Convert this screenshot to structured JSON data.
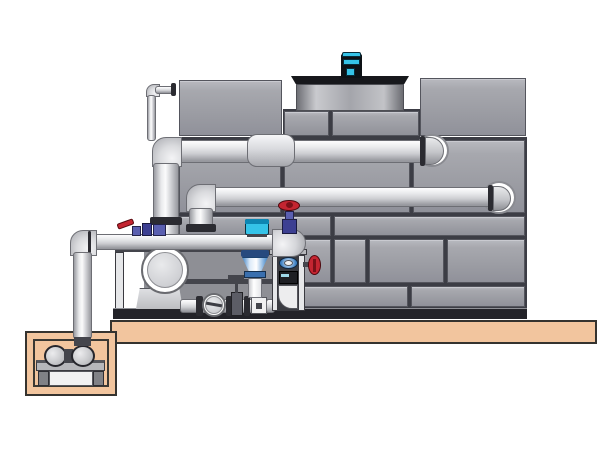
{
  "meta": {
    "description": "Technical illustration of a closed-circuit cooling tower with external piping, pump skid, suction sump pit, fan motor and valves",
    "visible_text": []
  },
  "colors": {
    "background": "#ffffff",
    "panel_gray": "#a3a4ab",
    "pipe_gray": "#dcdde0",
    "tan": "#f2c59e",
    "red": "#c42531",
    "teal": "#35c3e8",
    "blue": "#3d7fc1",
    "purple": "#5a5fb0",
    "dark": "#232329"
  },
  "components": [
    {
      "n": "platform-slab",
      "cls": "tan",
      "x": 110,
      "y": 320,
      "w": 487,
      "h": 24
    },
    {
      "n": "sump-pit-outer",
      "cls": "tan",
      "x": 25,
      "y": 331,
      "w": 92,
      "h": 65
    },
    {
      "n": "sump-pit-cavity",
      "cls": "tan-inner",
      "x": 33,
      "y": 339,
      "w": 76,
      "h": 48
    },
    {
      "n": "sump-pump-plate",
      "cls": "plate",
      "x": 36,
      "y": 360,
      "w": 69,
      "h": 11
    },
    {
      "n": "sump-pump-leg-left",
      "cls": "leg",
      "x": 38,
      "y": 371,
      "w": 11,
      "h": 15
    },
    {
      "n": "sump-pump-leg-right",
      "cls": "leg",
      "x": 93,
      "y": 371,
      "w": 11,
      "h": 15
    },
    {
      "n": "sump-pump-box",
      "cls": "whitebox",
      "x": 49,
      "y": 371,
      "w": 44,
      "h": 15
    },
    {
      "n": "sump-pump-bell-left",
      "cls": "pumpcirc ell",
      "x": 44,
      "y": 345,
      "w": 23,
      "h": 22
    },
    {
      "n": "sump-pump-coupling",
      "cls": "dark2",
      "x": 64,
      "y": 349,
      "w": 9,
      "h": 14
    },
    {
      "n": "sump-pump-bell-right",
      "cls": "pumpcirc ell",
      "x": 71,
      "y": 345,
      "w": 24,
      "h": 22
    },
    {
      "n": "tower-frame-underlay",
      "cls": "underlay",
      "x": 178,
      "y": 137,
      "w": 349,
      "h": 172
    },
    {
      "n": "tower-band-underlay",
      "cls": "underlay",
      "x": 283,
      "y": 109,
      "w": 137,
      "h": 30
    },
    {
      "n": "tower-panel-top-left",
      "cls": "panel",
      "x": 179,
      "y": 80,
      "w": 103,
      "h": 56
    },
    {
      "n": "tower-panel-top-right",
      "cls": "panel",
      "x": 420,
      "y": 78,
      "w": 106,
      "h": 58
    },
    {
      "n": "tower-panel-band-left",
      "cls": "panel",
      "x": 284,
      "y": 111,
      "w": 45,
      "h": 25
    },
    {
      "n": "tower-panel-band-right",
      "cls": "panel",
      "x": 332,
      "y": 111,
      "w": 87,
      "h": 25
    },
    {
      "n": "tower-panel",
      "cls": "panel",
      "x": 179,
      "y": 140,
      "w": 102,
      "h": 73
    },
    {
      "n": "tower-panel",
      "cls": "panel",
      "x": 284,
      "y": 140,
      "w": 126,
      "h": 73
    },
    {
      "n": "tower-panel",
      "cls": "panel",
      "x": 413,
      "y": 140,
      "w": 112,
      "h": 73
    },
    {
      "n": "tower-panel",
      "cls": "panel",
      "x": 179,
      "y": 216,
      "w": 152,
      "h": 20
    },
    {
      "n": "tower-panel",
      "cls": "panel",
      "x": 334,
      "y": 216,
      "w": 191,
      "h": 20
    },
    {
      "n": "tower-panel",
      "cls": "panel",
      "x": 179,
      "y": 239,
      "w": 152,
      "h": 44
    },
    {
      "n": "tower-panel",
      "cls": "panel",
      "x": 334,
      "y": 239,
      "w": 32,
      "h": 44
    },
    {
      "n": "tower-panel",
      "cls": "panel",
      "x": 369,
      "y": 239,
      "w": 75,
      "h": 44
    },
    {
      "n": "tower-panel",
      "cls": "panel",
      "x": 447,
      "y": 239,
      "w": 78,
      "h": 44
    },
    {
      "n": "tower-panel",
      "cls": "panel",
      "x": 179,
      "y": 286,
      "w": 229,
      "h": 21
    },
    {
      "n": "tower-panel",
      "cls": "panel",
      "x": 411,
      "y": 286,
      "w": 114,
      "h": 21
    },
    {
      "n": "tower-base-band",
      "cls": "darkband",
      "x": 178,
      "y": 308,
      "w": 349,
      "h": 11
    },
    {
      "n": "fan-deck-rim",
      "cls": "rim",
      "x": 291,
      "y": 76,
      "w": 118,
      "h": 8,
      "clip": "polygon(0 0,100% 0,96% 100%,4% 100%)"
    },
    {
      "n": "fan-cowl-drum",
      "cls": "drum",
      "x": 296,
      "y": 84,
      "w": 108,
      "h": 27
    },
    {
      "n": "fan-motor-base",
      "cls": "dark",
      "x": 339,
      "y": 76,
      "w": 25,
      "h": 4
    },
    {
      "n": "fan-motor-body",
      "cls": "motordark",
      "x": 341,
      "y": 54,
      "w": 21,
      "h": 24
    },
    {
      "n": "fan-motor-cap",
      "cls": "cyan",
      "x": 342,
      "y": 52,
      "w": 19,
      "h": 5,
      "r": "2px 2px 0 0"
    },
    {
      "n": "fan-motor-band",
      "cls": "cyan",
      "x": 343,
      "y": 59,
      "w": 17,
      "h": 6
    },
    {
      "n": "fan-motor-window",
      "cls": "cyan",
      "x": 346,
      "y": 68,
      "w": 9,
      "h": 8
    },
    {
      "n": "makeup-pipe-elbow",
      "cls": "elbow",
      "x": 146,
      "y": 84,
      "w": 14,
      "h": 13,
      "r": "8px 0 0 0"
    },
    {
      "n": "makeup-pipe-horizontal",
      "cls": "pipe-h",
      "x": 155,
      "y": 86,
      "w": 19,
      "h": 8
    },
    {
      "n": "makeup-pipe-wall-flange",
      "cls": "flange",
      "x": 171,
      "y": 83,
      "w": 5,
      "h": 13
    },
    {
      "n": "makeup-pipe-vertical",
      "cls": "pipe-v",
      "x": 147,
      "y": 95,
      "w": 9,
      "h": 46
    },
    {
      "n": "upper-header-wall-ring",
      "cls": "ring ell",
      "x": 415,
      "y": 134,
      "w": 34,
      "h": 33
    },
    {
      "n": "upper-header-pipe",
      "cls": "pipe-h",
      "x": 172,
      "y": 140,
      "w": 258,
      "h": 23
    },
    {
      "n": "upper-header-end-flange",
      "cls": "flange",
      "x": 420,
      "y": 136,
      "w": 5,
      "h": 30
    },
    {
      "n": "upper-header-dome",
      "cls": "dome",
      "x": 425,
      "y": 137,
      "w": 19,
      "h": 28,
      "r": "0 14px 14px 0"
    },
    {
      "n": "upper-header-elbow",
      "cls": "elbow",
      "x": 152,
      "y": 137,
      "w": 30,
      "h": 30,
      "r": "14px 0 0 0"
    },
    {
      "n": "upper-riser-pipe",
      "cls": "pipe-v",
      "x": 153,
      "y": 163,
      "w": 26,
      "h": 73
    },
    {
      "n": "upper-riser-flange",
      "cls": "flange",
      "x": 150,
      "y": 217,
      "w": 32,
      "h": 8
    },
    {
      "n": "upper-header-coupling",
      "cls": "coupling",
      "x": 247,
      "y": 134,
      "w": 48,
      "h": 33,
      "r": "10px"
    },
    {
      "n": "middle-header-wall-ring",
      "cls": "ring ell",
      "x": 482,
      "y": 181,
      "w": 34,
      "h": 33
    },
    {
      "n": "middle-header-pipe",
      "cls": "pipe-h",
      "x": 206,
      "y": 187,
      "w": 286,
      "h": 20
    },
    {
      "n": "middle-header-end-flange",
      "cls": "flange",
      "x": 488,
      "y": 185,
      "w": 5,
      "h": 26
    },
    {
      "n": "middle-header-dome",
      "cls": "dome",
      "x": 493,
      "y": 186,
      "w": 18,
      "h": 25,
      "r": "0 13px 13px 0"
    },
    {
      "n": "middle-header-elbow",
      "cls": "elbow",
      "x": 186,
      "y": 184,
      "w": 30,
      "h": 28,
      "r": "14px 0 0 0"
    },
    {
      "n": "middle-riser-pipe",
      "cls": "pipe-v",
      "x": 189,
      "y": 208,
      "w": 24,
      "h": 20
    },
    {
      "n": "middle-riser-flange",
      "cls": "flange",
      "x": 186,
      "y": 224,
      "w": 30,
      "h": 8
    },
    {
      "n": "pump-skid-backdrop",
      "cls": "skidback",
      "x": 144,
      "y": 250,
      "w": 158,
      "h": 60
    },
    {
      "n": "pump-skid-top-rail",
      "cls": "dark2",
      "x": 115,
      "y": 248,
      "w": 188,
      "h": 4
    },
    {
      "n": "pump-skid-mid-rail",
      "cls": "dark2",
      "x": 183,
      "y": 279,
      "w": 119,
      "h": 5
    },
    {
      "n": "pump-skid-left-column",
      "cls": "lightcol",
      "x": 115,
      "y": 252,
      "w": 9,
      "h": 58
    },
    {
      "n": "pump-skid-base",
      "cls": "darkband",
      "x": 113,
      "y": 308,
      "w": 191,
      "h": 11
    },
    {
      "n": "main-pump-pedestal",
      "cls": "pedestal",
      "x": 136,
      "y": 288,
      "w": 47,
      "h": 21,
      "clip": "polygon(8% 0,92% 0,100% 100%,0 100%)"
    },
    {
      "n": "main-pump-flange-ring",
      "cls": "ring2 ell",
      "x": 141,
      "y": 246,
      "w": 48,
      "h": 48
    },
    {
      "n": "main-pump-face",
      "cls": "pumpface ell",
      "x": 147,
      "y": 252,
      "w": 36,
      "h": 36
    },
    {
      "n": "suction-manifold-pipe",
      "cls": "pipe-h",
      "x": 180,
      "y": 299,
      "w": 94,
      "h": 14
    },
    {
      "n": "manifold-flange-1",
      "cls": "flange",
      "x": 196,
      "y": 296,
      "w": 7,
      "h": 20
    },
    {
      "n": "check-valve-ring",
      "cls": "ring2 ell",
      "x": 202,
      "y": 293,
      "w": 24,
      "h": 24
    },
    {
      "n": "check-valve-disc",
      "cls": "pumpface ell",
      "x": 205,
      "y": 296,
      "w": 18,
      "h": 18
    },
    {
      "n": "check-valve-slash",
      "cls": "slash",
      "x": 206,
      "y": 303,
      "w": 16,
      "h": 3,
      "rot": 10
    },
    {
      "n": "manifold-flange-2",
      "cls": "flange",
      "x": 226,
      "y": 296,
      "w": 6,
      "h": 20
    },
    {
      "n": "manifold-gate-valve-body",
      "cls": "gatebody",
      "x": 231,
      "y": 292,
      "w": 12,
      "h": 24
    },
    {
      "n": "manifold-gate-valve-stem",
      "cls": "dark2",
      "x": 235,
      "y": 279,
      "w": 3,
      "h": 14
    },
    {
      "n": "manifold-gate-valve-handle",
      "cls": "dark2",
      "x": 228,
      "y": 275,
      "w": 16,
      "h": 4
    },
    {
      "n": "manifold-flange-3",
      "cls": "flange",
      "x": 244,
      "y": 296,
      "w": 6,
      "h": 20
    },
    {
      "n": "manifold-union-block",
      "cls": "whitebox",
      "x": 251,
      "y": 297,
      "w": 16,
      "h": 17
    },
    {
      "n": "manifold-union-bolt",
      "cls": "dark2",
      "x": 256,
      "y": 303,
      "w": 6,
      "h": 6
    },
    {
      "n": "manifold-pipe-right",
      "cls": "pipe-h",
      "x": 266,
      "y": 299,
      "w": 9,
      "h": 14
    },
    {
      "n": "control-valve-top-flange",
      "cls": "blueflange",
      "x": 241,
      "y": 250,
      "w": 28,
      "h": 7
    },
    {
      "n": "control-valve-cone",
      "cls": "cone",
      "x": 242,
      "y": 257,
      "w": 26,
      "h": 15,
      "clip": "polygon(0 0,100% 0,73% 100%,27% 100%)"
    },
    {
      "n": "control-valve-ring",
      "cls": "blueflange2",
      "x": 244,
      "y": 271,
      "w": 22,
      "h": 7
    },
    {
      "n": "control-valve-drop-pipe",
      "cls": "whitepipe",
      "x": 248,
      "y": 278,
      "w": 14,
      "h": 20
    },
    {
      "n": "riser-frame-top-plate",
      "cls": "plate2",
      "x": 269,
      "y": 249,
      "w": 38,
      "h": 6
    },
    {
      "n": "riser-frame-left-rail",
      "cls": "lightcol",
      "x": 272,
      "y": 255,
      "w": 6,
      "h": 56
    },
    {
      "n": "riser-frame-right-rail",
      "cls": "lightcol",
      "x": 298,
      "y": 255,
      "w": 7,
      "h": 56
    },
    {
      "n": "riser-frame-interior",
      "cls": "darkint",
      "x": 278,
      "y": 255,
      "w": 20,
      "h": 56
    },
    {
      "n": "riser-frame-inner-elbow",
      "cls": "innerelbow",
      "x": 278,
      "y": 285,
      "w": 20,
      "h": 24,
      "r": "0 0 0 14px"
    },
    {
      "n": "riser-sight-glass",
      "cls": "lens ell",
      "x": 279,
      "y": 257,
      "w": 19,
      "h": 12
    },
    {
      "n": "riser-sight-glass-center",
      "cls": "whitebox ell",
      "x": 284,
      "y": 260,
      "w": 9,
      "h": 6
    },
    {
      "n": "riser-control-box",
      "cls": "ctrlbox",
      "x": 279,
      "y": 271,
      "w": 19,
      "h": 13
    },
    {
      "n": "riser-control-box-stripe",
      "cls": "stripe",
      "x": 281,
      "y": 274,
      "w": 8,
      "h": 3
    },
    {
      "n": "side-valve-stem",
      "cls": "dark2",
      "x": 303,
      "y": 262,
      "w": 8,
      "h": 5
    },
    {
      "n": "side-valve-handwheel",
      "cls": "redwheel ell",
      "x": 308,
      "y": 255,
      "w": 13,
      "h": 20
    },
    {
      "n": "side-valve-hub",
      "cls": "redhub",
      "x": 313,
      "y": 259,
      "w": 3,
      "h": 13
    },
    {
      "n": "lower-header-pipe",
      "cls": "pipe-h",
      "x": 86,
      "y": 234,
      "w": 198,
      "h": 16
    },
    {
      "n": "lower-header-left-elbow",
      "cls": "elbow",
      "x": 70,
      "y": 230,
      "w": 27,
      "h": 26,
      "r": "13px 0 0 0"
    },
    {
      "n": "lower-elbow-flange-line",
      "cls": "flange",
      "x": 88,
      "y": 231,
      "w": 3,
      "h": 22
    },
    {
      "n": "sump-drop-pipe",
      "cls": "pipe-v",
      "x": 73,
      "y": 252,
      "w": 19,
      "h": 87
    },
    {
      "n": "sump-drop-pipe-collar",
      "cls": "dark2",
      "x": 74,
      "y": 337,
      "w": 17,
      "h": 9
    },
    {
      "n": "lower-header-right-elbow",
      "cls": "elbow-r",
      "x": 272,
      "y": 229,
      "w": 34,
      "h": 28,
      "r": "0 15px 15px 0"
    },
    {
      "n": "bypass-ball-valve-body",
      "cls": "purple",
      "x": 132,
      "y": 226,
      "w": 9,
      "h": 10
    },
    {
      "n": "bypass-valve-block",
      "cls": "purple2",
      "x": 142,
      "y": 223,
      "w": 10,
      "h": 13
    },
    {
      "n": "bypass-valve-union",
      "cls": "purple",
      "x": 153,
      "y": 224,
      "w": 13,
      "h": 12
    },
    {
      "n": "bypass-valve-red-lever",
      "cls": "redlever",
      "x": 117,
      "y": 221,
      "w": 17,
      "h": 6,
      "rot": -20
    },
    {
      "n": "control-valve-actuator",
      "cls": "teal",
      "x": 245,
      "y": 219,
      "w": 24,
      "h": 16,
      "r": "2px"
    },
    {
      "n": "control-valve-actuator-lid",
      "cls": "tealdark",
      "x": 245,
      "y": 219,
      "w": 24,
      "h": 5,
      "r": "2px 2px 0 0"
    },
    {
      "n": "control-valve-actuator-base",
      "cls": "dark2",
      "x": 247,
      "y": 234,
      "w": 20,
      "h": 3
    },
    {
      "n": "gate-valve-body-top",
      "cls": "purple2",
      "x": 282,
      "y": 219,
      "w": 15,
      "h": 15
    },
    {
      "n": "gate-valve-bonnet",
      "cls": "purple",
      "x": 285,
      "y": 211,
      "w": 9,
      "h": 9
    },
    {
      "n": "gate-valve-handwheel",
      "cls": "redwheel ell",
      "x": 278,
      "y": 200,
      "w": 22,
      "h": 11
    },
    {
      "n": "gate-valve-hub",
      "cls": "redhub ell",
      "x": 286,
      "y": 202,
      "w": 7,
      "h": 6
    }
  ]
}
